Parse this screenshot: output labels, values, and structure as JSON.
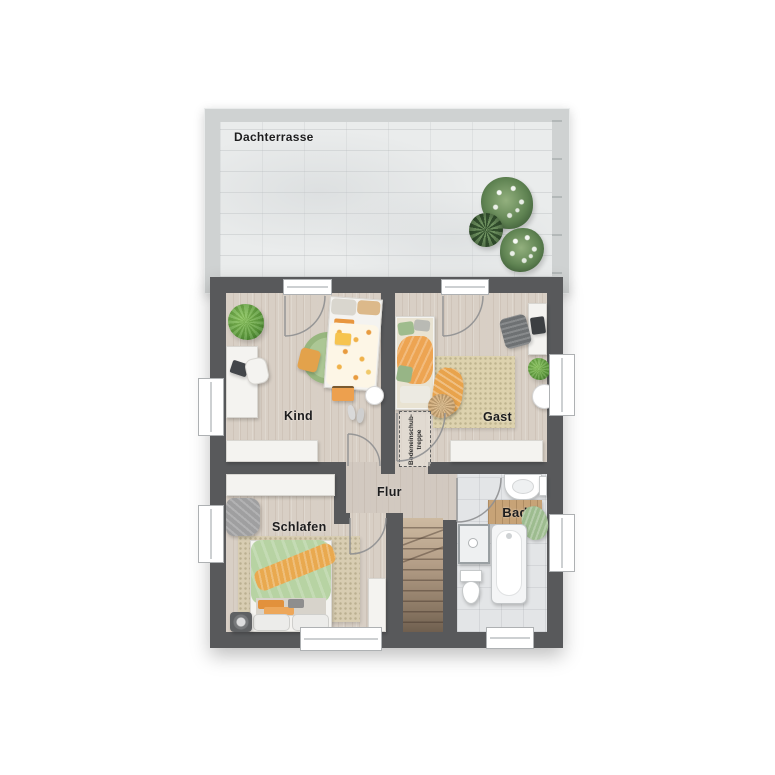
{
  "terrace": {
    "label": "Dachterrasse"
  },
  "rooms": {
    "kind": {
      "label": "Kind"
    },
    "gast": {
      "label": "Gast"
    },
    "flur": {
      "label": "Flur"
    },
    "schlafen": {
      "label": "Schlafen"
    },
    "bad": {
      "label": "Bad"
    }
  },
  "attic_ladder": {
    "line1": "Bodeneinschub-",
    "line2": "treppe"
  },
  "colors": {
    "wall_dark": "#58595b",
    "terrace_wall": "#cfd2d2",
    "terrace_floor": "#eaecec",
    "wood_floor": "#d8cfc5",
    "hall_floor": "#d2c9c0",
    "bath_tiles": "#e3e5e7",
    "accent_orange": "#e9a34c",
    "accent_green": "#aecf97",
    "rug_beige": "#ddd2ae",
    "stair_wood": "#a8927c"
  }
}
